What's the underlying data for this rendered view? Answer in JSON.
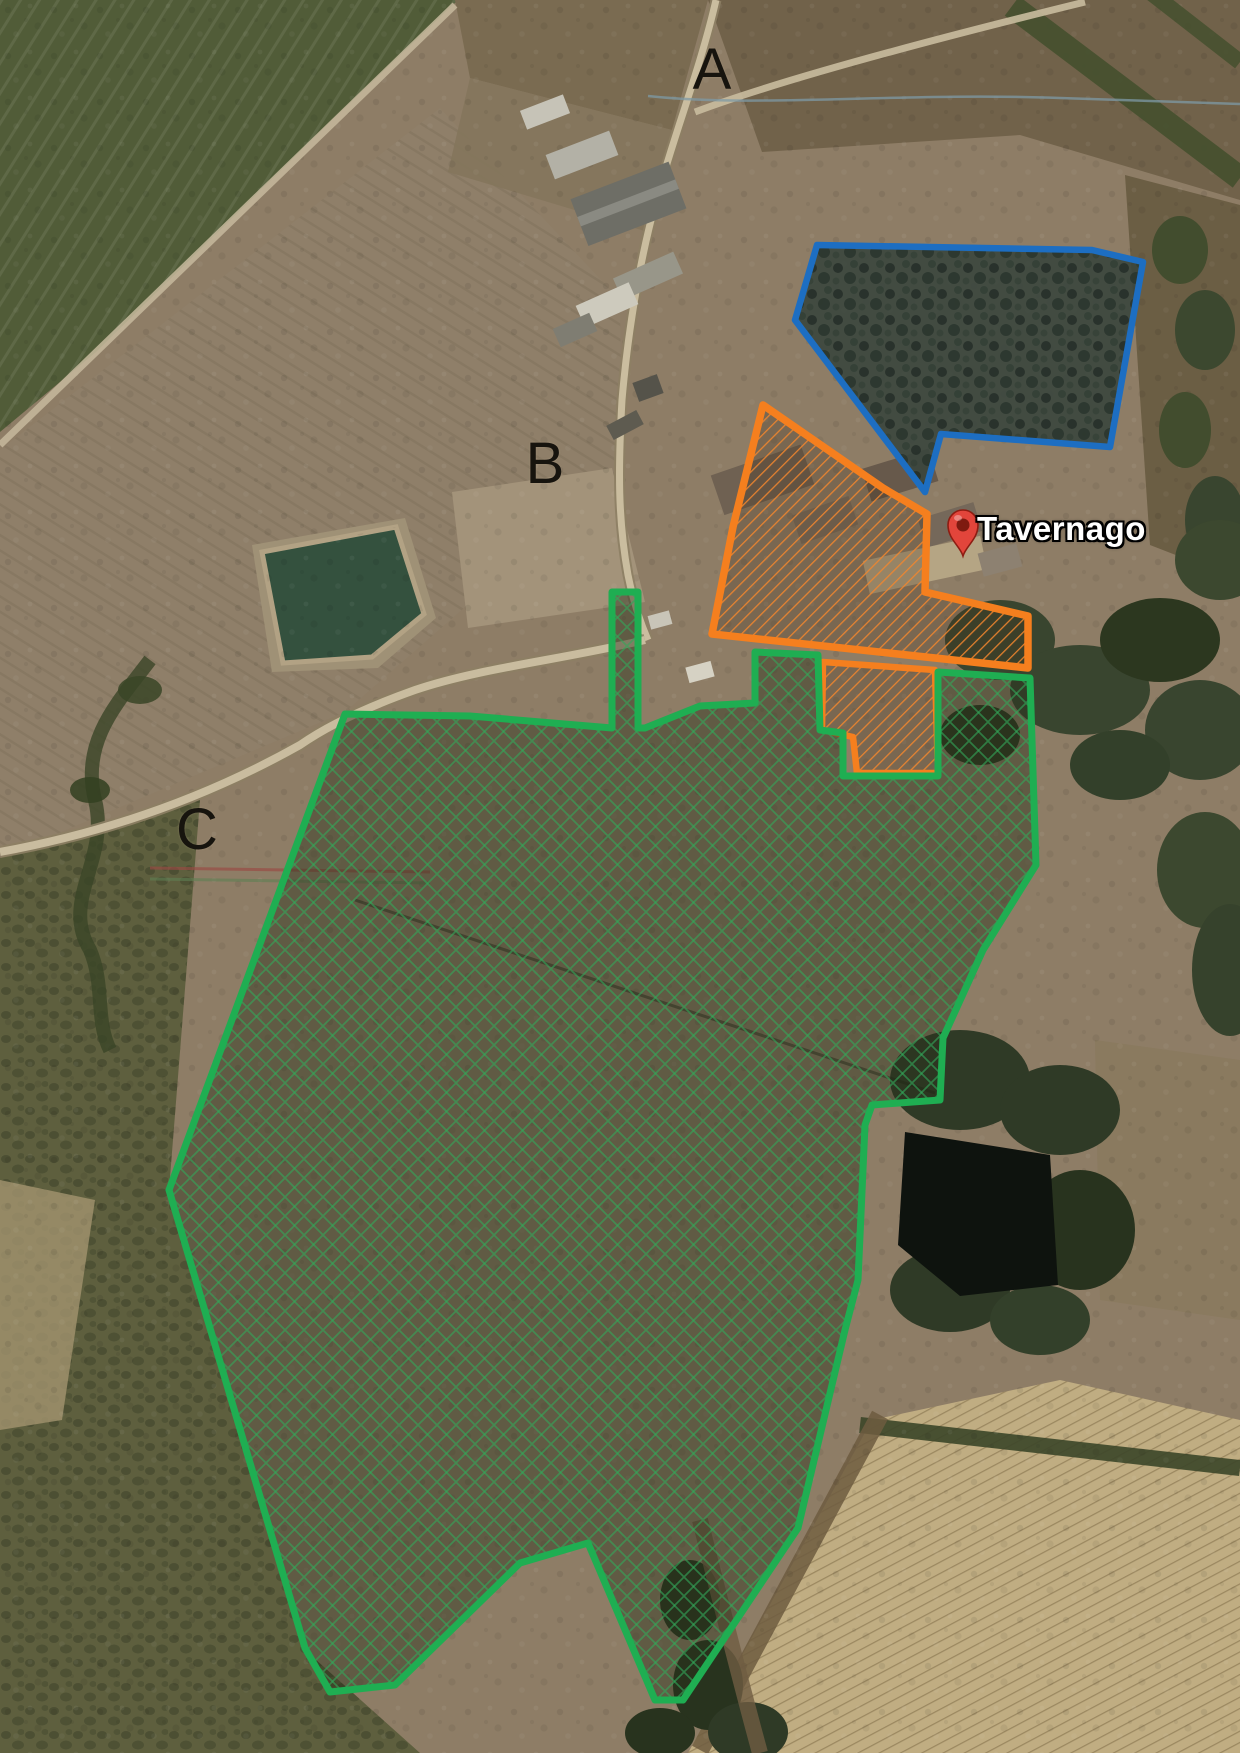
{
  "map": {
    "place_marker": {
      "label": "Tavernago",
      "pin_color": "#e2453b",
      "pin_hole_color": "#7e1a10",
      "x": 963,
      "y": 556
    },
    "area_labels": [
      {
        "id": "A",
        "text": "A",
        "x": 712,
        "y": 70
      },
      {
        "id": "B",
        "text": "B",
        "x": 545,
        "y": 464
      },
      {
        "id": "C",
        "text": "C",
        "x": 197,
        "y": 830
      }
    ],
    "zones": [
      {
        "id": "zone-a-blue",
        "name": "woodland-parcel-A",
        "outline_color": "#1d6ec2",
        "stroke_width": 6.5,
        "fill_pattern": "fill-zone-blue",
        "points": [
          [
            817,
            245
          ],
          [
            1092,
            250
          ],
          [
            1143,
            262
          ],
          [
            1110,
            447
          ],
          [
            941,
            434
          ],
          [
            925,
            492
          ],
          [
            795,
            320
          ]
        ]
      },
      {
        "id": "zone-b-orange-main",
        "name": "farmstead-parcel-B",
        "outline_color": "#f57f1e",
        "stroke_width": 7.5,
        "fill_pattern": "hatch-orange",
        "points": [
          [
            763,
            405
          ],
          [
            883,
            488
          ],
          [
            927,
            514
          ],
          [
            925,
            592
          ],
          [
            1028,
            616
          ],
          [
            1028,
            668
          ],
          [
            712,
            634
          ],
          [
            733,
            527
          ]
        ]
      },
      {
        "id": "zone-b-orange-annex",
        "name": "farmstead-annex-parcel-B",
        "outline_color": "#f57f1e",
        "stroke_width": 6.5,
        "fill_pattern": "hatch-orange",
        "points": [
          [
            823,
            662
          ],
          [
            935,
            670
          ],
          [
            938,
            773
          ],
          [
            857,
            773
          ],
          [
            853,
            737
          ],
          [
            822,
            730
          ]
        ]
      },
      {
        "id": "zone-c-green",
        "name": "large-land-parcel-C",
        "outline_color": "#1fae52",
        "stroke_width": 7,
        "fill_pattern": "hatch-green",
        "points": [
          [
            755,
            652
          ],
          [
            818,
            655
          ],
          [
            820,
            730
          ],
          [
            843,
            733
          ],
          [
            843,
            776
          ],
          [
            938,
            776
          ],
          [
            938,
            672
          ],
          [
            1030,
            678
          ],
          [
            1036,
            865
          ],
          [
            983,
            950
          ],
          [
            943,
            1038
          ],
          [
            940,
            1100
          ],
          [
            872,
            1105
          ],
          [
            865,
            1125
          ],
          [
            858,
            1280
          ],
          [
            845,
            1330
          ],
          [
            798,
            1528
          ],
          [
            683,
            1700
          ],
          [
            655,
            1700
          ],
          [
            588,
            1543
          ],
          [
            520,
            1563
          ],
          [
            395,
            1685
          ],
          [
            330,
            1692
          ],
          [
            305,
            1648
          ],
          [
            169,
            1190
          ],
          [
            345,
            714
          ],
          [
            470,
            716
          ],
          [
            612,
            728
          ],
          [
            612,
            592
          ],
          [
            638,
            592
          ],
          [
            638,
            728
          ],
          [
            645,
            728
          ],
          [
            700,
            706
          ],
          [
            755,
            703
          ]
        ]
      }
    ]
  }
}
